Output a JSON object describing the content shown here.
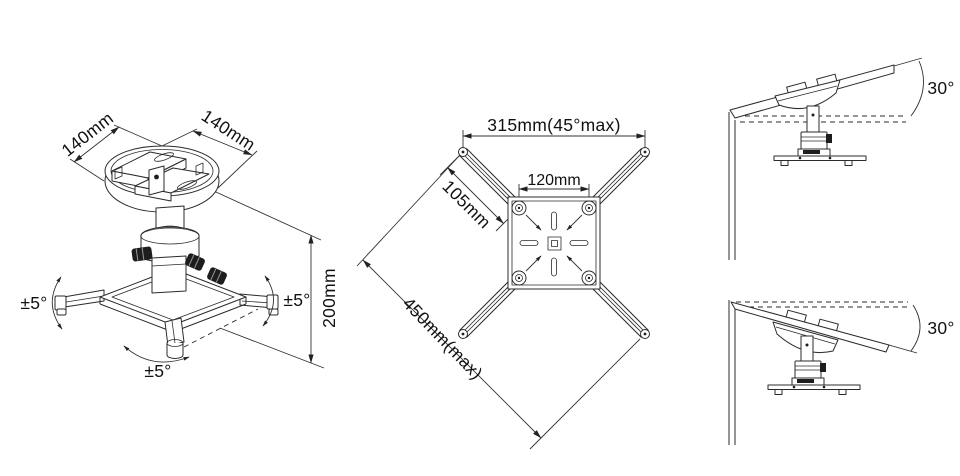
{
  "colors": {
    "background": "#ffffff",
    "line": "#2b2b2b",
    "dim_line": "#333333",
    "text": "#111111"
  },
  "isometric_view": {
    "dim_left": "140mm",
    "dim_right": "140mm",
    "height": "200mm",
    "tilt_left": "±5°",
    "tilt_right": "±5°",
    "swivel": "±5°"
  },
  "top_view": {
    "span": "315mm(45°max)",
    "plate": "120mm",
    "arm": "105mm",
    "diagonal": "450mm(max)"
  },
  "side_view_up": {
    "angle": "30°"
  },
  "side_view_down": {
    "angle": "30°"
  }
}
